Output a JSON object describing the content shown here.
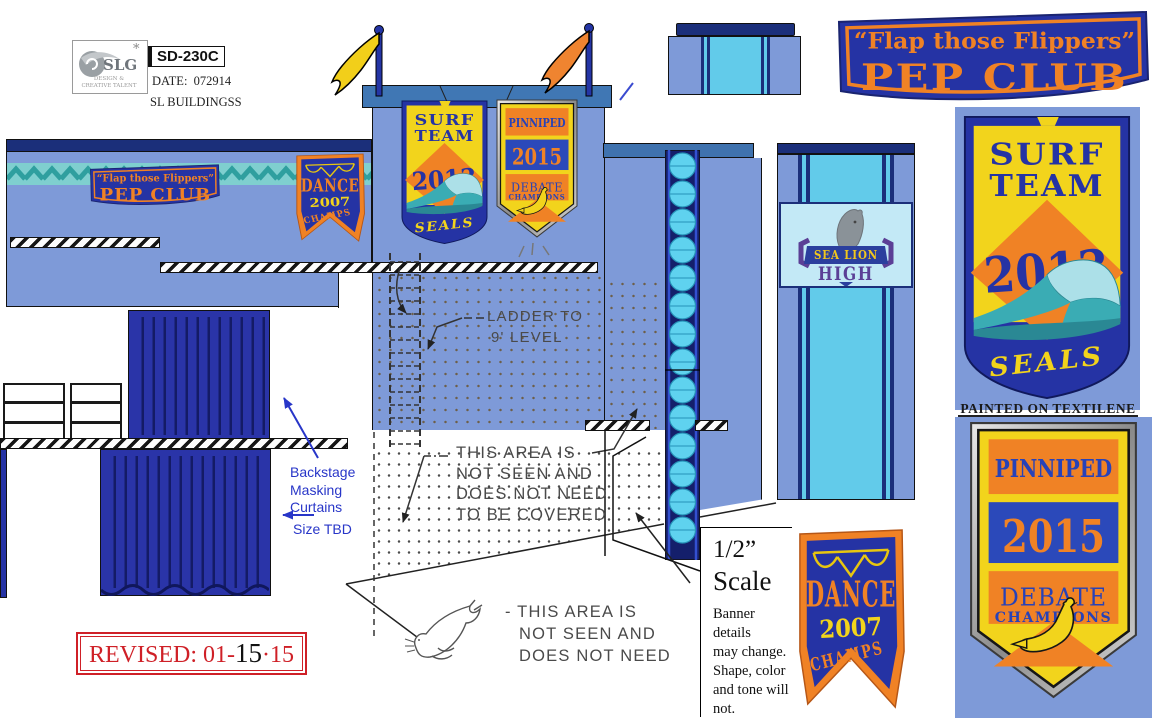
{
  "header": {
    "brand": "SLG",
    "brand_star": "*",
    "brand_caption_1": "DESIGN &",
    "brand_caption_2": "CREATIVE TALENT",
    "drawing_number": "SD-230C",
    "date": "DATE:  072914",
    "project": "SL BUILDINGSS"
  },
  "banners": {
    "pep_club": {
      "line1": "“Flap those Flippers”",
      "line2": "PEP CLUB"
    },
    "surf_team": {
      "word1": "SURF",
      "word2": "TEAM",
      "year": "2013",
      "footer": "SEALS"
    },
    "pinniped": {
      "title": "PINNIPED",
      "year": "2015",
      "subtitle": "DEBATE",
      "subtitle2": "CHAMPIONS"
    },
    "dance": {
      "title": "DANCE",
      "year": "2007",
      "subtitle": "CHAMPS"
    },
    "school": {
      "line1": "SEA LION",
      "line2": "HIGH"
    }
  },
  "annotations": {
    "ladder_line1": "LADDER TO",
    "ladder_line2": "9' LEVEL",
    "hidden_area_upper": [
      "THIS AREA IS",
      "NOT SEEN AND",
      "DOES NOT NEED",
      "TO BE COVERED"
    ],
    "hidden_area_lower": [
      "- THIS AREA IS",
      "NOT SEEN AND",
      "DOES NOT NEED"
    ],
    "backstage": [
      "Backstage",
      "Masking",
      "Curtains"
    ],
    "backstage_size": "Size TBD",
    "painted": "PAINTED ON TEXTILENE",
    "revised_prefix": "REVISED: 01-",
    "revised_mid": "15",
    "revised_suffix": "·15",
    "scale_value": "1/2”",
    "scale_label": "Scale",
    "scale_note": [
      "Banner details",
      "may change.",
      "Shape, color",
      "and tone will",
      "not."
    ]
  },
  "colors": {
    "wall": "#7E9AD8",
    "navy": "#1B2F7A",
    "banner_blue": "#2533A4",
    "orange": "#F08225",
    "yellow": "#F2D41C",
    "teal": "#3AACB4",
    "cyan": "#67D4F0",
    "red": "#CF2027",
    "note_blue": "#2836C8"
  }
}
